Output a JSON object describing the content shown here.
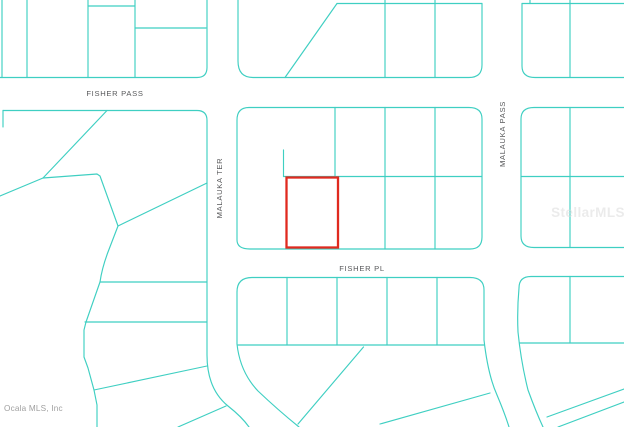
{
  "map": {
    "labels": {
      "fisher_pass": "FISHER PASS",
      "fisher_pl": "FISHER PL",
      "malauka_ter": "MALAUKA TER",
      "malauka_pass": "MALAUKA PASS"
    },
    "watermark": "StellarMLS",
    "attribution": "Ocala MLS, Inc",
    "colors": {
      "line": "#3fcfc2",
      "highlight": "#e02a1f",
      "label": "#58595b",
      "watermark": "#dcdcdc",
      "attribution": "#9f9f9f",
      "background": "#ffffff"
    }
  }
}
